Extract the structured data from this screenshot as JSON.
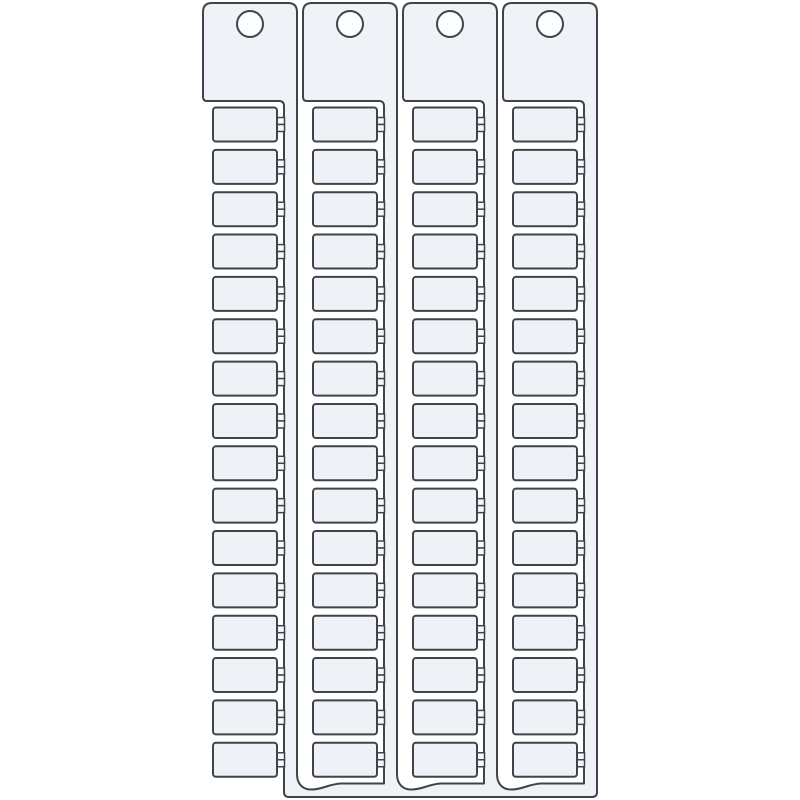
{
  "illustration": {
    "kind": "terminal-marker-strip-card",
    "strip_count": 4,
    "tags_per_strip": 16,
    "colors": {
      "background": "#ffffff",
      "outline": "#3f444a",
      "body_fill": "#eff3f8",
      "tag_fill": "#eef2f7",
      "nub_fill": "#f7fafd",
      "hole_fill": "#fbfdff"
    },
    "stroke_width": 2,
    "geometry": {
      "canvas": {
        "width": 800,
        "height": 800
      },
      "strip_pitch": 100,
      "tab": {
        "x": 203,
        "y": 3,
        "width": 94,
        "height": 98,
        "corner_radius": 9
      },
      "hole": {
        "cx": 250,
        "cy": 24,
        "r": 13
      },
      "spine": {
        "inner_x": 284,
        "outer_x": 297
      },
      "tag": {
        "x": 213,
        "width": 64,
        "first_top": 107.5,
        "row_pitch": 42.35,
        "height": 34,
        "corner_radius": 3
      },
      "nub": {
        "x": 276.5,
        "width": 8,
        "half_height": 7
      },
      "bottom_bar": {
        "inner_y": 783.5,
        "outer_y": 797,
        "left_x": 284,
        "right_x": 597,
        "corner_radius": 5
      },
      "wave": {
        "start_y": 774,
        "dip": 6
      },
      "inner_corner_radius": 5,
      "tab_foot_radius": 4
    }
  }
}
